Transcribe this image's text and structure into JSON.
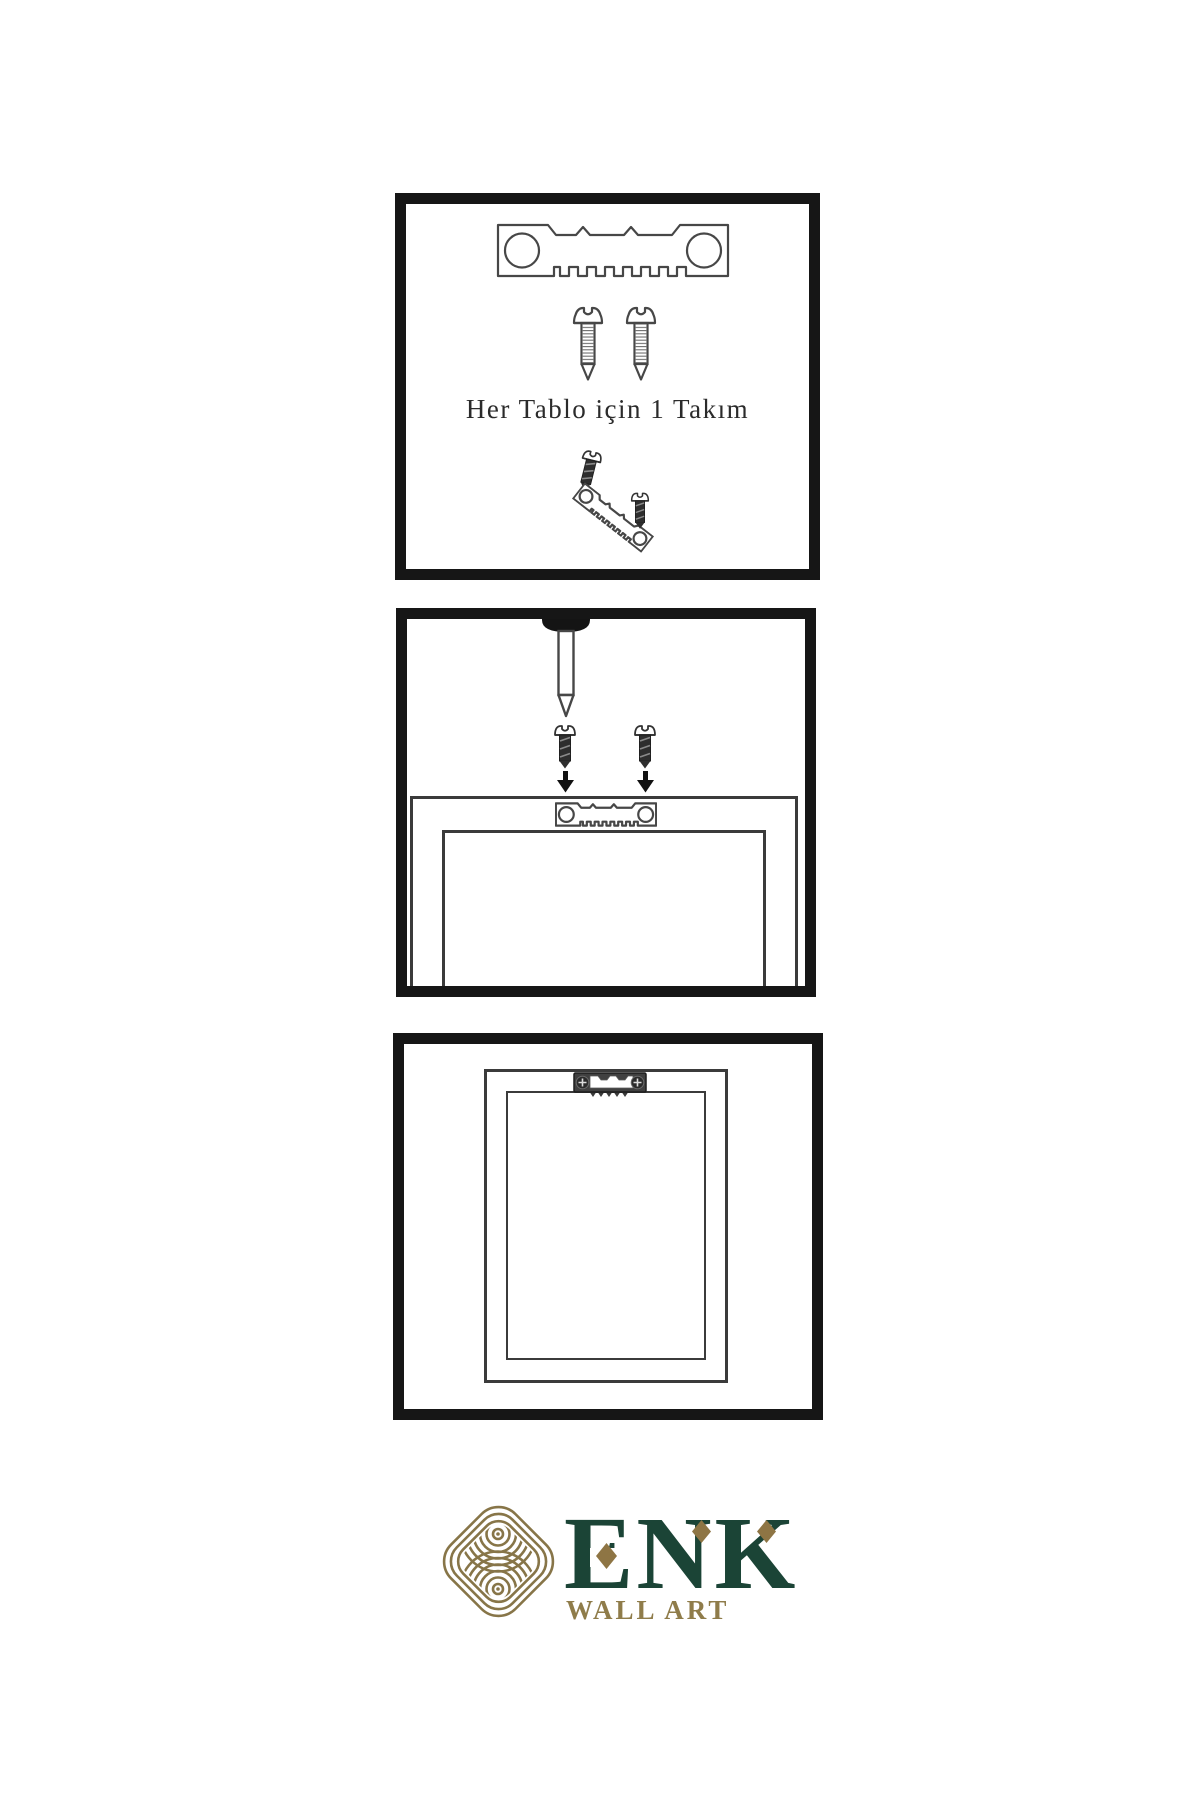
{
  "page": {
    "background": "#ffffff"
  },
  "colors": {
    "panel_border": "#161616",
    "line_art": "#474747",
    "screw_dark": "#2e2e2e",
    "logo_green": "#1b4436",
    "logo_gold": "#877548",
    "diamond_gold": "#8e7544",
    "tagline_gold": "#8f7c4a"
  },
  "panels": [
    {
      "id": "hardware-kit",
      "caption": "Her Tablo için 1 Takım"
    },
    {
      "id": "wall-installation"
    },
    {
      "id": "hung-frame"
    }
  ],
  "logo": {
    "brand": "ENK",
    "tagline": "WALL ART"
  },
  "icons": [
    "sawtooth-hanger-icon",
    "screw-icon",
    "wall-nail-icon",
    "down-arrow-icon",
    "hanger-plate-icon",
    "knot-logo-icon"
  ]
}
